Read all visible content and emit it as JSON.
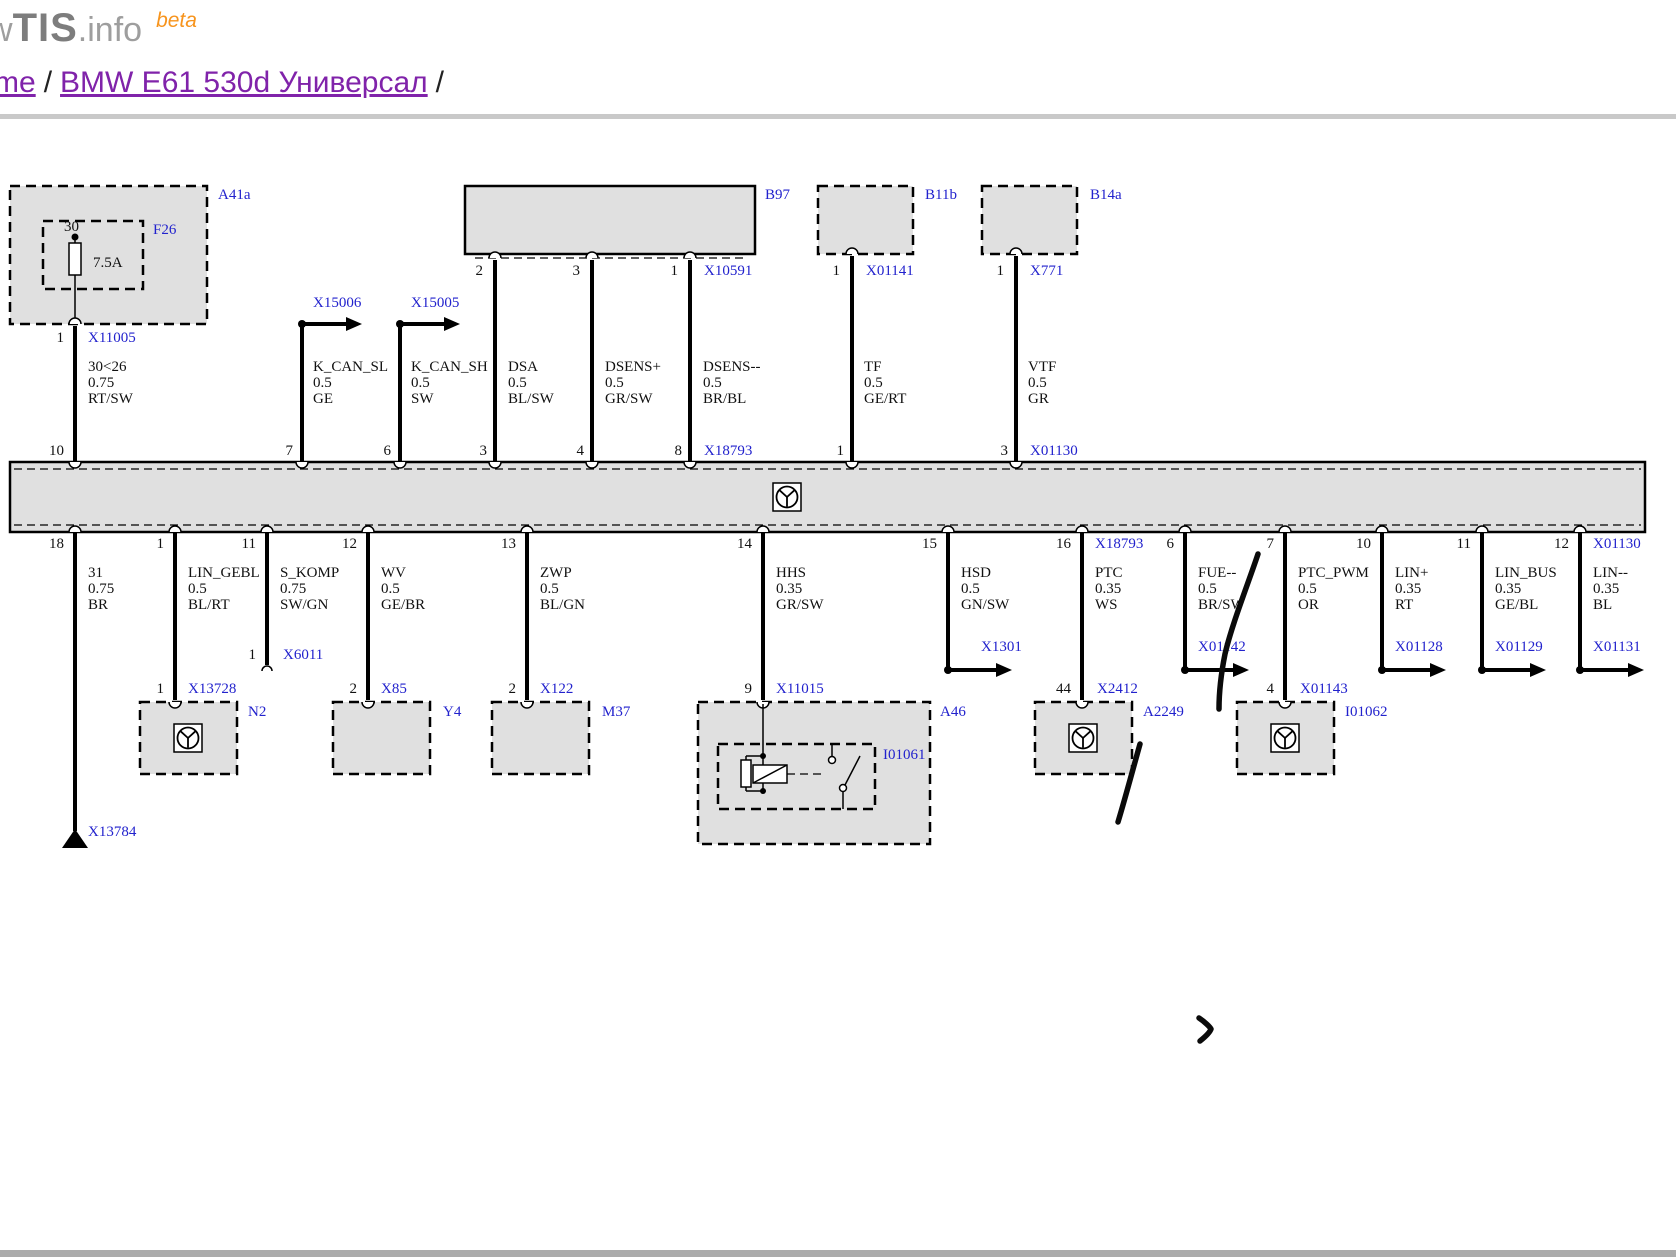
{
  "header": {
    "logo_w": "w",
    "logo_brand": "TIS",
    "logo_suffix": ".info",
    "logo_beta": "beta",
    "breadcrumb_home": "me",
    "breadcrumb_sep": "/",
    "breadcrumb_page": "BMW E61 530d Универсал",
    "breadcrumb_trailing": "/"
  },
  "colors": {
    "label_blue": "#2222cd",
    "link_purple": "#8023aa",
    "beta_orange": "#f7941d",
    "box_fill": "#e0e0e0"
  },
  "d": {
    "a41a": {
      "label": "A41a",
      "fuse_label": "F26",
      "terminal": "30",
      "rating": "7.5A",
      "pin": "1",
      "conn": "X11005",
      "wire": [
        "30<26",
        "0.75",
        "RT/SW"
      ],
      "bar_pin": "10"
    },
    "can1": {
      "conn": "X15006",
      "wire": [
        "K_CAN_SL",
        "0.5",
        "GE"
      ],
      "bar_pin": "7"
    },
    "can2": {
      "conn": "X15005",
      "wire": [
        "K_CAN_SH",
        "0.5",
        "SW"
      ],
      "bar_pin": "6"
    },
    "b97": {
      "label": "B97",
      "conn": "X10591",
      "pins": [
        "2",
        "3",
        "1"
      ],
      "wires": [
        [
          "DSA",
          "0.5",
          "BL/SW"
        ],
        [
          "DSENS+",
          "0.5",
          "GR/SW"
        ],
        [
          "DSENS--",
          "0.5",
          "BR/BL"
        ]
      ],
      "bar_pins": [
        "3",
        "4",
        "8"
      ],
      "bar_conn": "X18793"
    },
    "b11b": {
      "label": "B11b",
      "pin": "1",
      "conn": "X01141",
      "wire": [
        "TF",
        "0.5",
        "GE/RT"
      ],
      "bar_pin": "1"
    },
    "b14a": {
      "label": "B14a",
      "pin": "1",
      "conn": "X771",
      "wire": [
        "VTF",
        "0.5",
        "GR"
      ],
      "bar_pin": "3",
      "bar_conn": "X01130"
    },
    "gnd": {
      "bar_pin": "18",
      "wire": [
        "31",
        "0.75",
        "BR"
      ],
      "conn": "X13784"
    },
    "n2": {
      "bar_pin": "1",
      "wire": [
        "LIN_GEBL",
        "0.5",
        "BL/RT"
      ],
      "pin": "1",
      "conn": "X13728",
      "box": "N2"
    },
    "komp": {
      "bar_pin": "11",
      "wire": [
        "S_KOMP",
        "0.75",
        "SW/GN"
      ],
      "pin": "1",
      "conn": "X6011"
    },
    "y4": {
      "bar_pin": "12",
      "wire": [
        "WV",
        "0.5",
        "GE/BR"
      ],
      "pin": "2",
      "conn": "X85",
      "box": "Y4"
    },
    "m37": {
      "bar_pin": "13",
      "wire": [
        "ZWP",
        "0.5",
        "BL/GN"
      ],
      "pin": "2",
      "conn": "X122",
      "box": "M37"
    },
    "a46": {
      "bar_pin": "14",
      "wire": [
        "HHS",
        "0.35",
        "GR/SW"
      ],
      "pin": "9",
      "conn": "X11015",
      "box": "A46",
      "inner": "I01061"
    },
    "hsd": {
      "bar_pin": "15",
      "wire": [
        "HSD",
        "0.5",
        "GN/SW"
      ],
      "conn": "X1301"
    },
    "a2249": {
      "bar_pin": "16",
      "bar_conn": "X18793",
      "wire": [
        "PTC",
        "0.35",
        "WS"
      ],
      "pin": "44",
      "conn": "X2412",
      "box": "A2249"
    },
    "fue": {
      "bar_pin": "6",
      "wire": [
        "FUE--",
        "0.5",
        "BR/SW"
      ],
      "conn": "X01142"
    },
    "i01062": {
      "bar_pin": "7",
      "wire": [
        "PTC_PWM",
        "0.5",
        "OR"
      ],
      "pin": "4",
      "conn": "X01143",
      "box": "I01062"
    },
    "lin_p": {
      "bar_pin": "10",
      "wire": [
        "LIN+",
        "0.35",
        "RT"
      ],
      "conn": "X01128"
    },
    "lin_bus": {
      "bar_pin": "11",
      "wire": [
        "LIN_BUS",
        "0.35",
        "GE/BL"
      ],
      "conn": "X01129"
    },
    "lin_m": {
      "bar_pin": "12",
      "bar_conn": "X01130",
      "wire": [
        "LIN--",
        "0.35",
        "BL"
      ],
      "conn": "X01131"
    }
  }
}
